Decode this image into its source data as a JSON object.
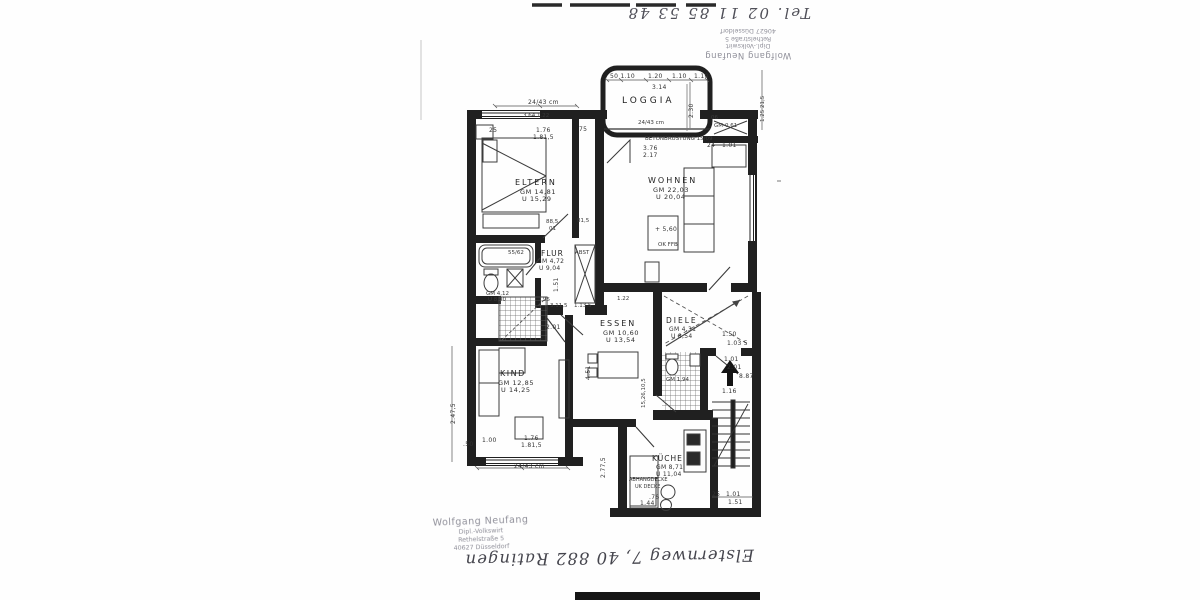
{
  "rooms": {
    "loggia": {
      "name": "LOGGIA"
    },
    "eltern": {
      "name": "ELTERN",
      "gm": "GM 14,81",
      "u": "U 15,29"
    },
    "wohnen": {
      "name": "WOHNEN",
      "gm": "GM 22,03",
      "u": "U 20,04"
    },
    "flur": {
      "name": "FLUR",
      "gm": "GM 4,72",
      "u": "U 9,04"
    },
    "abst": {
      "name": "ABST"
    },
    "abst_klein": {
      "no": "06",
      "gm": "GM-0,61"
    },
    "essen": {
      "name": "ESSEN",
      "gm": "GM 10,60",
      "u": "U 13,54"
    },
    "kind": {
      "name": "KIND",
      "gm": "GM 12,85",
      "u": "U 14,25"
    },
    "diele": {
      "name": "DIELE",
      "gm": "GM 4,31",
      "u": "U 8,54"
    },
    "kueche": {
      "name": "KÜCHE",
      "gm": "GM 8,71",
      "u": "U 11,04"
    },
    "bad": {
      "gm": "GM 4,12",
      "u": "U 8,90"
    },
    "wc": {
      "gm": "GM 1,94"
    }
  },
  "annotations": {
    "betonbruestung": "BETONBRÜSTUNG 15/09",
    "niveau": "+ 5,60",
    "ok_ffb": "OK FFB",
    "abhangdecke": "ABHANGDECKE",
    "uk_decke": "UK DECKE"
  },
  "dims": [
    "24/43 cm",
    "3.64  1.22",
    "25",
    "1.76",
    "1.81,5",
    "75",
    "50  1.10",
    "1.20",
    "1.10",
    "1.10",
    "3.14",
    "2.30",
    "24/43 cm",
    "3.76",
    "2.17",
    "24",
    "1.01",
    "88,5",
    "01",
    "81,5",
    "1.51",
    "95",
    "3.11,5",
    "1.13,5",
    "2.01",
    "4.51",
    "1.22",
    "1.50",
    "1.03 5",
    "1.01",
    "2.01",
    "8.87",
    "1.16",
    "25",
    "1.01",
    "1.51",
    "1.44",
    ".76",
    "2.77,5",
    "1.76",
    "1.81,5",
    "1.00",
    ".50",
    "24/43 cm",
    "15,26,10,5",
    "2.47,5",
    "1.25 21,5",
    "55/62"
  ],
  "stamp": {
    "line1": "Wolfgang Neufang",
    "line2": "Dipl.-Volkswirt",
    "line3": "Rethelstraße 5",
    "line4": "40627 Düsseldorf"
  },
  "handwriting": {
    "top": "Tel. 02 11 85 53 48",
    "bottom": "Elsternweg 7, 40 882 Ratingen"
  }
}
